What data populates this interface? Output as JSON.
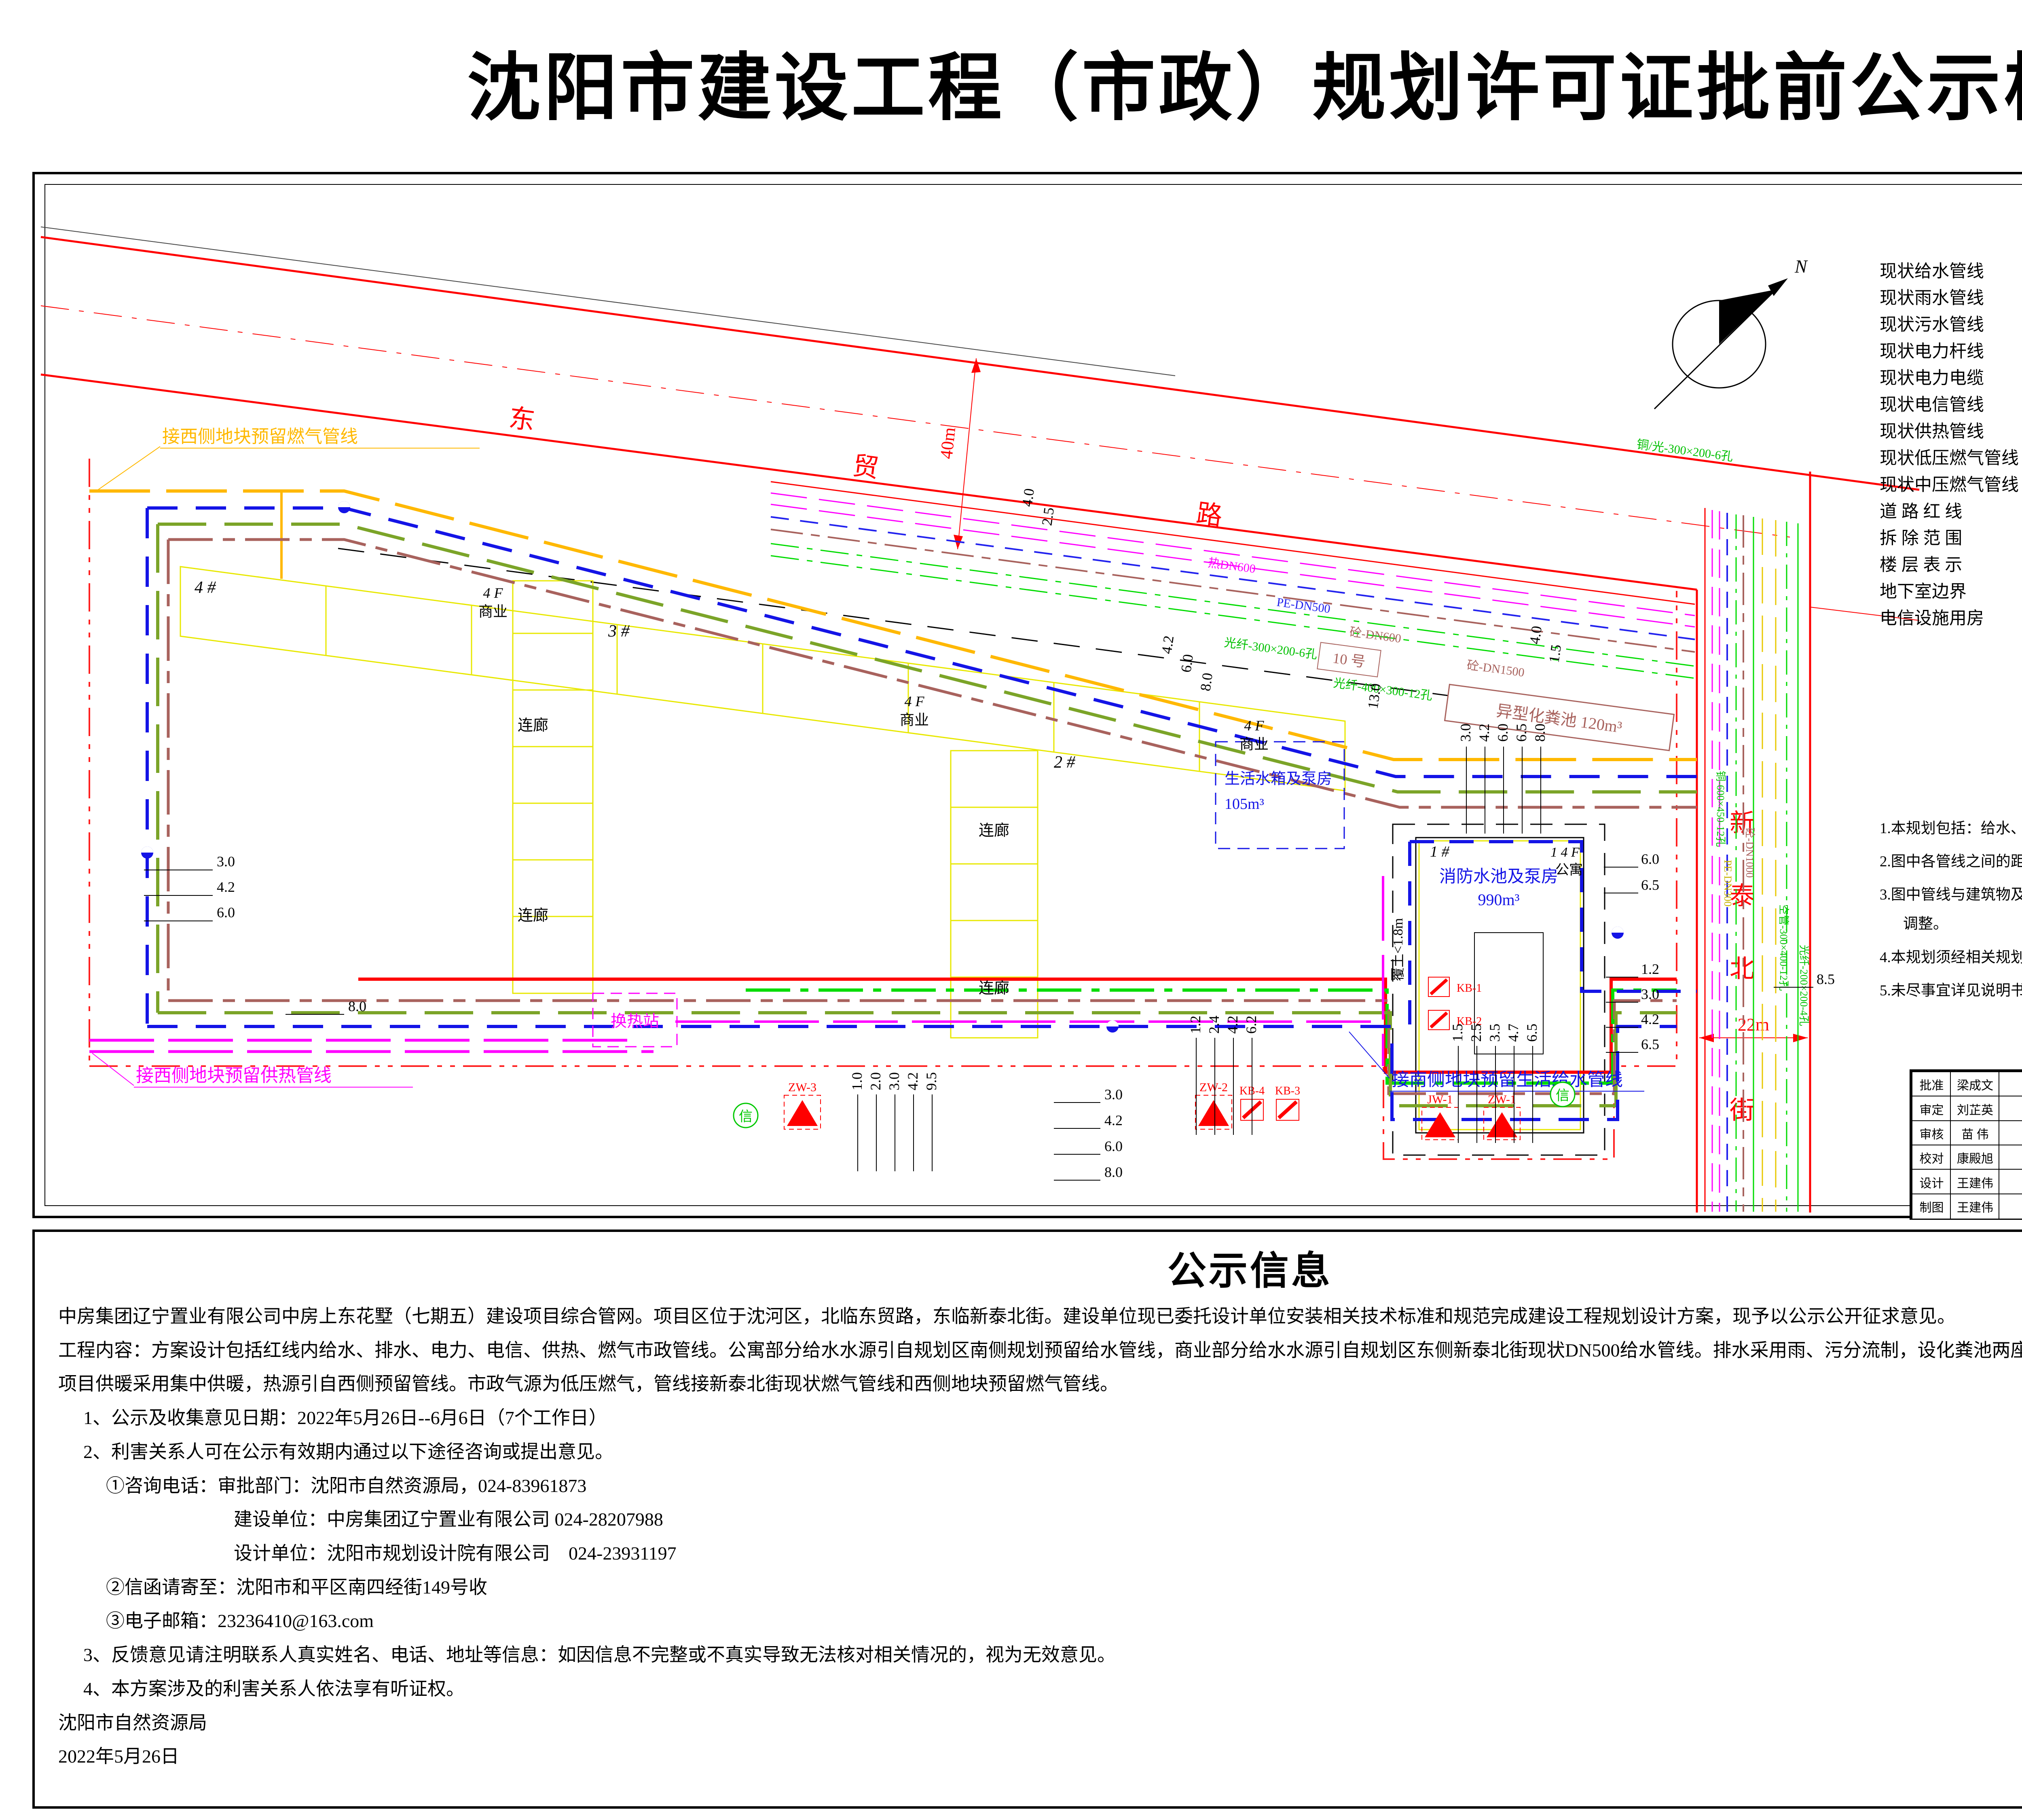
{
  "title": "沈阳市建设工程（市政）规划许可证批前公示板",
  "legend": {
    "title": "图    例",
    "left": [
      "现状给水管线",
      "现状雨水管线",
      "现状污水管线",
      "现状电力杆线",
      "现状电力电缆",
      "现状电信管线",
      "现状供热管线",
      "现状低压燃气管线",
      "现状中压燃气管线",
      "道 路 红 线",
      "拆 除 范 围",
      "楼 层 表 示",
      "地下室边界",
      "电信设施用房"
    ],
    "right": [
      "规划给水管线",
      "规划污水管线",
      "规划雨水管线",
      "规划电力管线",
      "规划电信管线",
      "规划供热管线",
      "规划低压燃气管线",
      "消  火  栓",
      "钢 砼 化 粪 池",
      "异 型 化 粪 池",
      "地 下 开 闭 站",
      "地 下 变 电 所"
    ],
    "tags": {
      "high": "高压",
      "low": "低压",
      "t": "T",
      "s": "S",
      "s2": "S",
      "xin": "信",
      "septic_no": "8 号",
      "floor1": "一层",
      "floor1f": "1F",
      "floor10": "十层",
      "floor10f": "10F"
    }
  },
  "notes": {
    "title": "说    明",
    "items": [
      "1.本规划包括：给水、排水、电力、电信、供热、燃气等六项专业。",
      "2.图中各管线之间的距离为中心距，单位为米。",
      "3.图中管线与建筑物及其他管线距离参照综合平面图,各管线进出建筑物的位置可做适当调整。",
      "4.本规划须经相关规划管理部门审批同意后，方可执行。",
      "5.未尽事宜详见说明书，或按有关规范执行。"
    ]
  },
  "map": {
    "road": {
      "c1": "东",
      "c2": "贸",
      "c3": "路",
      "w": "40m"
    },
    "street": {
      "c1": "新",
      "c2": "泰",
      "c3": "北",
      "c4": "街",
      "w": "22m"
    },
    "compass": "N",
    "labels": {
      "b4": "4 #",
      "b3": "3 #",
      "b2": "2 #",
      "b1": "1 #",
      "box10": "10 号",
      "biz_fl": "4 F",
      "biz": "商业",
      "apt_fl": "1 4 F",
      "apt": "公寓",
      "corridor": "连廊",
      "hx": "换热站",
      "futu": "覆土<1.8m",
      "tank": "生活水箱及泵房",
      "tank_v": "105m³",
      "fire": "消防水池及泵房",
      "fire_v": "990m³",
      "septic": "异型化粪池 120m³",
      "gas_west": "接西侧地块预留燃气管线",
      "heat_west": "接西侧地块预留供热管线",
      "water_south": "接南侧地块预留生活给水管线"
    },
    "pipes": {
      "p1": "热DN600",
      "p2": "PE-DN500",
      "p3": "砼-DN600",
      "p4": "砼-DN1500",
      "p5": "光纤-300×200-6孔",
      "p6": "光纤-400×300-12孔",
      "p7": "铜/光-300×200-6孔",
      "s1": "铜-600×450-12孔",
      "s2": "砼-DN1000",
      "s3": "空管-300×400-12孔",
      "s4": "PE-DN300",
      "s5": "光纤-200×200-4孔"
    },
    "equip": {
      "zw1": "ZW-1",
      "zw2": "ZW-2",
      "zw3": "ZW-3",
      "jw1": "JW-1",
      "kb1": "KB-1",
      "kb2": "KB-2",
      "kb3": "KB-3",
      "kb4": "KB-4"
    },
    "dims": {
      "l1": [
        "3.0",
        "4.2",
        "6.0"
      ],
      "l2": "8.0",
      "t1": [
        "4.2",
        "6.0",
        "8.0"
      ],
      "t2": "13.0",
      "t3": [
        "4.0",
        "1.5"
      ],
      "t4": [
        "4.0",
        "2.5"
      ],
      "c1": [
        "3.0",
        "4.2",
        "6.0",
        "6.5",
        "8.0"
      ],
      "r1": [
        "6.0",
        "6.5"
      ],
      "r2": [
        "1.2",
        "3.0",
        "4.2",
        "6.5"
      ],
      "r3": "8.5",
      "b1": [
        "1.2",
        "2.4",
        "4.2",
        "6.2"
      ],
      "b2": [
        "3.0",
        "4.2",
        "6.0",
        "8.0"
      ],
      "b3": [
        "1.5",
        "2.5",
        "3.5",
        "4.7",
        "6.5"
      ],
      "s1": [
        "1.0",
        "2.0",
        "3.0",
        "4.2",
        "9.5"
      ]
    }
  },
  "titleblock": {
    "roles": [
      {
        "label": "批准",
        "name": "梁成文"
      },
      {
        "label": "审定",
        "name": "刘芷英"
      },
      {
        "label": "审核",
        "name": "苗 伟"
      },
      {
        "label": "校对",
        "name": "康殿旭"
      },
      {
        "label": "设计",
        "name": "王建伟"
      },
      {
        "label": "制图",
        "name": "王建伟"
      }
    ],
    "cert1": "规划甲级设计证书",
    "cert2": "141056 号",
    "logo_g": "G",
    "company_cn": "沈阳市规划设计研究院有限公司",
    "company_en": "SHEN YANG URBAN PLANNING DESIGN & RESEARCH INSTITUTE Co.,Ltd",
    "company_addr": "地 址：沈阳市和平区南三好街1 号　邮 编：110004　电 话：(024",
    "project_label": "项目名称",
    "project_loc1": "东贸路南",
    "project_loc2": "新泰北街西",
    "project_name": "中房上东花墅（七期五）建设项目室外管线规划",
    "design_no_label": "设计号",
    "design_no": "204-147",
    "scale_label": "比 例",
    "scale": "1:500",
    "type_label": "图 别",
    "type": "修详",
    "sheet_label": "图 号",
    "sheet_no": "03",
    "drawing_label": "图纸名称",
    "drawing_name": "管线综合平面图",
    "pm_label": "项目负责",
    "pm": "王建伟",
    "lead_label": "专业负责",
    "date_label": "日 期",
    "date": "2021.01"
  },
  "notice": {
    "title": "公示信息",
    "lines": [
      "中房集团辽宁置业有限公司中房上东花墅（七期五）建设项目综合管网。项目区位于沈河区，北临东贸路，东临新泰北街。建设单位现已委托设计单位安装相关技术标准和规范完成建设工程规划设计方案，现予以公示公开征求意见。",
      "工程内容：方案设计包括红线内给水、排水、电力、电信、供热、燃气市政管线。公寓部分给水水源引自规划区南侧规划预留给水管线，商业部分给水水源引自规划区东侧新泰北街现状DN500给水管线。排水采用雨、污分流制，设化粪池两座。",
      "项目供暖采用集中供暖，热源引自西侧预留管线。市政气源为低压燃气，管线接新泰北街现状燃气管线和西侧地块预留燃气管线。",
      "1、公示及收集意见日期：2022年5月26日--6月6日（7个工作日）",
      "2、利害关系人可在公示有效期内通过以下途径咨询或提出意见。",
      "①咨询电话：审批部门：沈阳市自然资源局，024-83961873",
      "建设单位：中房集团辽宁置业有限公司 024-28207988",
      "设计单位：沈阳市规划设计院有限公司　024-23931197",
      "②信函请寄至：沈阳市和平区南四经街149号收",
      "③电子邮箱：23236410@163.com",
      "3、反馈意见请注明联系人真实姓名、电话、地址等信息：如因信息不完整或不真实导致无法核对相关情况的，视为无效意见。",
      "4、本方案涉及的利害关系人依法享有听证权。",
      "沈阳市自然资源局",
      "2022年5月26日"
    ]
  },
  "colors": {
    "water": "#1414E6",
    "rain_plan": "#7BA428",
    "sewage": "#A8625D",
    "power": "#FF0000",
    "telecom": "#00DC00",
    "heat": "#FF00FF",
    "gas": "#FFB800",
    "road_red": "#FF0000",
    "boundary": "#FF2020"
  }
}
